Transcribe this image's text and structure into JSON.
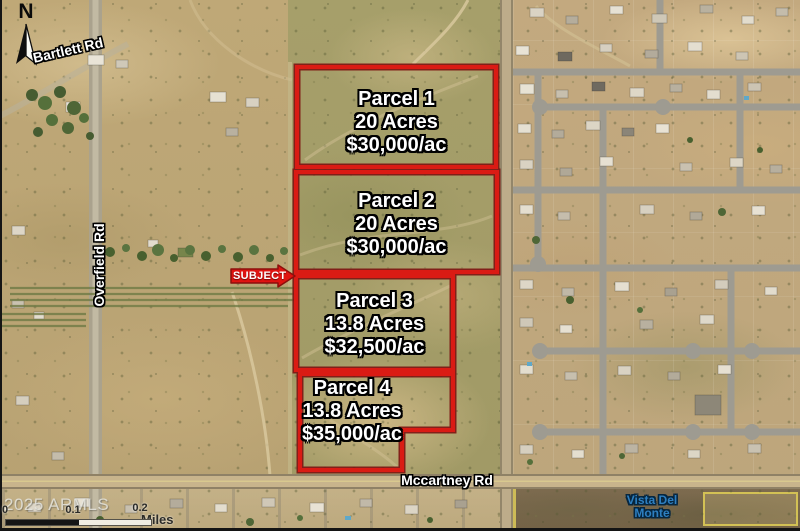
{
  "map": {
    "compass": {
      "label": "N"
    },
    "roads": {
      "bartlett": {
        "label": "Bartlett Rd"
      },
      "overfield": {
        "label": "Overfield Rd"
      },
      "mccartney": {
        "label": "Mccartney Rd"
      }
    },
    "subject_marker": {
      "label": "SUBJECT"
    },
    "parcels": [
      {
        "name": "Parcel 1",
        "size": "20 Acres",
        "price": "$30,000/ac"
      },
      {
        "name": "Parcel 2",
        "size": "20 Acres",
        "price": "$30,000/ac"
      },
      {
        "name": "Parcel 3",
        "size": "13.8 Acres",
        "price": "$32,500/ac"
      },
      {
        "name": "Parcel 4",
        "size": "13.8 Acres",
        "price": "$35,000/ac"
      }
    ],
    "neighborhood": {
      "line1": "Vista Del",
      "line2": "Monte"
    },
    "watermark": "2025 ARMLS",
    "scale_bar": {
      "ticks": [
        "0",
        "0.1",
        "0.2"
      ],
      "unit": "Miles"
    },
    "colors": {
      "parcel_outline": "#da1b14",
      "subject_marker": "#e01411",
      "road_label": "#ffffff",
      "neighborhood_label": "#2e7fc0",
      "watermark": "#e8e8e2"
    }
  }
}
